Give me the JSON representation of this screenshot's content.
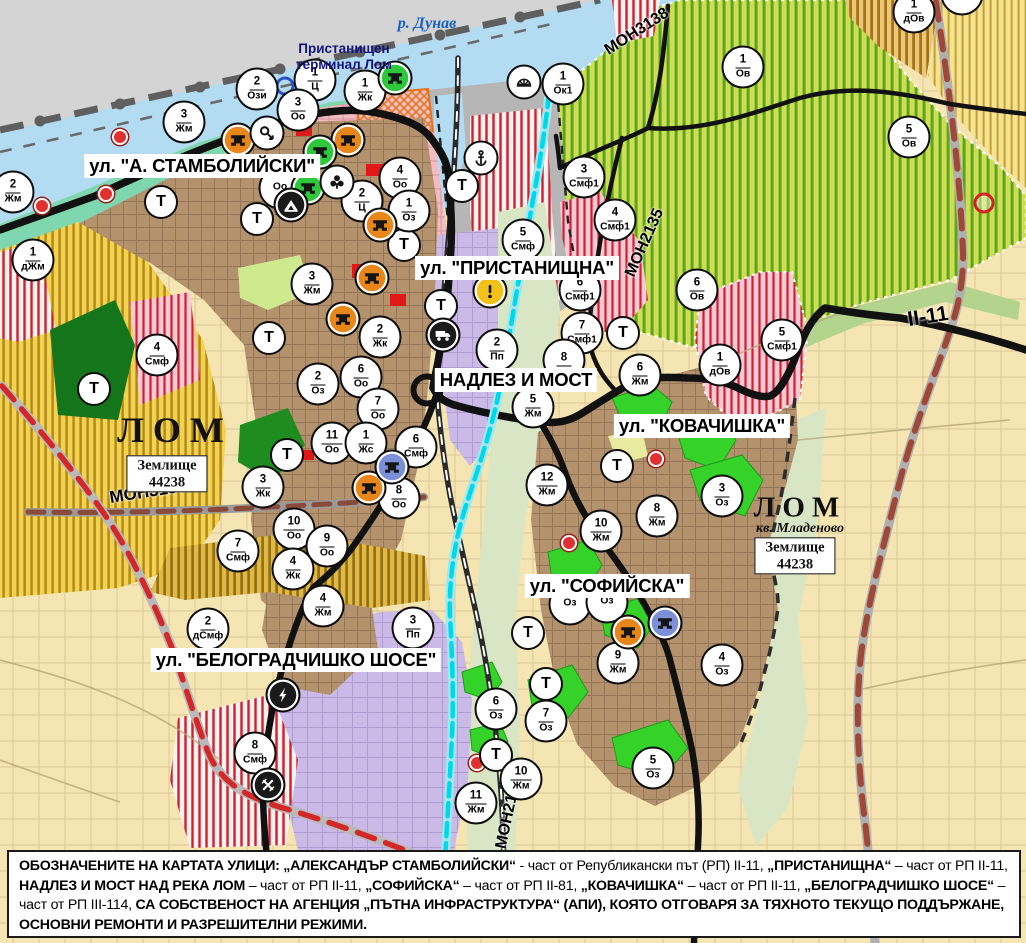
{
  "t_symbol": "Т",
  "labels": {
    "river": "р. Дунав",
    "port_line1": "Пристанищен",
    "port_line2": "терминал Лом",
    "lom": "ЛОМ",
    "kv": "кв. Младеново",
    "zem": "Землище",
    "zem_num": "44238"
  },
  "street_labels": [
    {
      "text": "ул. \"А. СТАМБОЛИЙСКИ\"",
      "x": 202,
      "y": 166
    },
    {
      "text": "ул. \"ПРИСТАНИЩНА\"",
      "x": 517,
      "y": 268
    },
    {
      "text": "НАДЛЕЗ И МОСТ",
      "x": 516,
      "y": 380
    },
    {
      "text": "ул. \"КОВАЧИШКА\"",
      "x": 702,
      "y": 426
    },
    {
      "text": "ул. \"СОФИЙСКА\"",
      "x": 607,
      "y": 586
    },
    {
      "text": "ул. \"БЕЛОГРАДЧИШКО ШОСЕ\"",
      "x": 296,
      "y": 660
    }
  ],
  "road_labels": [
    {
      "text": "МОН3139",
      "x": 148,
      "y": 492,
      "rot": -9,
      "size": 17
    },
    {
      "text": "МОН3138",
      "x": 637,
      "y": 32,
      "rot": -33,
      "size": 16
    },
    {
      "text": "МОН2135",
      "x": 645,
      "y": 243,
      "rot": -66,
      "size": 16
    },
    {
      "text": "МОН2136",
      "x": 509,
      "y": 813,
      "rot": -78,
      "size": 16
    },
    {
      "text": "II-11",
      "x": 928,
      "y": 317,
      "rot": -9,
      "size": 21
    }
  ],
  "zone_markers": [
    {
      "n": "2",
      "c": "Ози",
      "x": 257,
      "y": 89
    },
    {
      "n": "1",
      "c": "Ц",
      "x": 315,
      "y": 80
    },
    {
      "n": "1",
      "c": "Жк",
      "x": 365,
      "y": 91
    },
    {
      "n": "3",
      "c": "Оо",
      "x": 298,
      "y": 110
    },
    {
      "n": "3",
      "c": "Жм",
      "x": 184,
      "y": 122
    },
    {
      "n": "2",
      "c": "Жм",
      "x": 13,
      "y": 192
    },
    {
      "n": "1",
      "c": "дЖм",
      "x": 33,
      "y": 260
    },
    {
      "n": "4",
      "c": "Оо",
      "x": 400,
      "y": 178
    },
    {
      "n": "2",
      "c": "Ц",
      "x": 362,
      "y": 201
    },
    {
      "n": "1",
      "c": "Оз",
      "x": 409,
      "y": 211
    },
    {
      "n": "3",
      "c": "Жм",
      "x": 312,
      "y": 284
    },
    {
      "n": "",
      "c": "Оо",
      "x": 280,
      "y": 188
    },
    {
      "n": "4",
      "c": "Смф",
      "x": 157,
      "y": 355
    },
    {
      "n": "2",
      "c": "Жк",
      "x": 380,
      "y": 337
    },
    {
      "n": "2",
      "c": "Оз",
      "x": 318,
      "y": 384
    },
    {
      "n": "6",
      "c": "Оо",
      "x": 361,
      "y": 377
    },
    {
      "n": "7",
      "c": "Оо",
      "x": 378,
      "y": 409
    },
    {
      "n": "11",
      "c": "Оо",
      "x": 332,
      "y": 443
    },
    {
      "n": "1",
      "c": "Жс",
      "x": 366,
      "y": 443
    },
    {
      "n": "6",
      "c": "Смф",
      "x": 416,
      "y": 447
    },
    {
      "n": "8",
      "c": "Оо",
      "x": 399,
      "y": 498
    },
    {
      "n": "3",
      "c": "Жк",
      "x": 263,
      "y": 487
    },
    {
      "n": "10",
      "c": "Оо",
      "x": 294,
      "y": 529
    },
    {
      "n": "9",
      "c": "Оо",
      "x": 327,
      "y": 546
    },
    {
      "n": "7",
      "c": "Смф",
      "x": 238,
      "y": 551
    },
    {
      "n": "4",
      "c": "Жк",
      "x": 293,
      "y": 569
    },
    {
      "n": "2",
      "c": "Пп",
      "x": 497,
      "y": 350
    },
    {
      "n": "5",
      "c": "Смф",
      "x": 523,
      "y": 240
    },
    {
      "n": "1",
      "c": "Ок1",
      "x": 563,
      "y": 84
    },
    {
      "n": "3",
      "c": "Смф1",
      "x": 584,
      "y": 177
    },
    {
      "n": "4",
      "c": "Смф1",
      "x": 615,
      "y": 220
    },
    {
      "n": "6",
      "c": "Смф1",
      "x": 580,
      "y": 290
    },
    {
      "n": "7",
      "c": "Смф1",
      "x": 582,
      "y": 333
    },
    {
      "n": "8",
      "c": "",
      "x": 564,
      "y": 360
    },
    {
      "n": "5",
      "c": "Жм",
      "x": 533,
      "y": 407
    },
    {
      "n": "6",
      "c": "Жм",
      "x": 640,
      "y": 375
    },
    {
      "n": "6",
      "c": "Ов",
      "x": 697,
      "y": 290
    },
    {
      "n": "1",
      "c": "Ов",
      "x": 743,
      "y": 67
    },
    {
      "n": "5",
      "c": "Ов",
      "x": 909,
      "y": 137
    },
    {
      "n": "1",
      "c": "дОв",
      "x": 914,
      "y": 12
    },
    {
      "n": "",
      "c": "дОв",
      "x": 962,
      "y": -6
    },
    {
      "n": "5",
      "c": "Смф1",
      "x": 782,
      "y": 340
    },
    {
      "n": "1",
      "c": "дОв",
      "x": 720,
      "y": 365
    },
    {
      "n": "3",
      "c": "Оз",
      "x": 722,
      "y": 496
    },
    {
      "n": "8",
      "c": "Жм",
      "x": 657,
      "y": 516
    },
    {
      "n": "10",
      "c": "Жм",
      "x": 601,
      "y": 531
    },
    {
      "n": "12",
      "c": "Жм",
      "x": 547,
      "y": 485
    },
    {
      "n": "",
      "c": "Оз",
      "x": 570,
      "y": 604
    },
    {
      "n": "",
      "c": "Оз",
      "x": 607,
      "y": 602
    },
    {
      "n": "9",
      "c": "Жм",
      "x": 618,
      "y": 663
    },
    {
      "n": "4",
      "c": "Оз",
      "x": 722,
      "y": 665
    },
    {
      "n": "6",
      "c": "Оз",
      "x": 496,
      "y": 709
    },
    {
      "n": "7",
      "c": "Оз",
      "x": 546,
      "y": 721
    },
    {
      "n": "10",
      "c": "Жм",
      "x": 521,
      "y": 779
    },
    {
      "n": "11",
      "c": "Жм",
      "x": 476,
      "y": 803
    },
    {
      "n": "5",
      "c": "Оз",
      "x": 653,
      "y": 768
    },
    {
      "n": "2",
      "c": "дСмф",
      "x": 208,
      "y": 629
    },
    {
      "n": "4",
      "c": "Жм",
      "x": 323,
      "y": 606
    },
    {
      "n": "3",
      "c": "Пп",
      "x": 413,
      "y": 628
    },
    {
      "n": "8",
      "c": "Смф",
      "x": 255,
      "y": 753
    }
  ],
  "t_markers": [
    [
      161,
      202
    ],
    [
      257,
      219
    ],
    [
      404,
      245
    ],
    [
      462,
      186
    ],
    [
      441,
      306
    ],
    [
      623,
      333
    ],
    [
      617,
      466
    ],
    [
      94,
      389
    ],
    [
      269,
      338
    ],
    [
      287,
      455
    ],
    [
      528,
      633
    ],
    [
      546,
      684
    ],
    [
      496,
      755
    ]
  ],
  "icon_markers": [
    {
      "type": "monument",
      "variant": "orange",
      "x": 238,
      "y": 140
    },
    {
      "type": "monument",
      "variant": "orange",
      "x": 348,
      "y": 140
    },
    {
      "type": "monument",
      "variant": "orange",
      "x": 380,
      "y": 225
    },
    {
      "type": "monument",
      "variant": "orange",
      "x": 372,
      "y": 278
    },
    {
      "type": "monument",
      "variant": "orange",
      "x": 343,
      "y": 319
    },
    {
      "type": "monument",
      "variant": "orange",
      "x": 369,
      "y": 488
    },
    {
      "type": "monument",
      "variant": "orange",
      "x": 628,
      "y": 632
    },
    {
      "type": "monument",
      "variant": "green",
      "x": 320,
      "y": 152
    },
    {
      "type": "monument",
      "variant": "green",
      "x": 308,
      "y": 188
    },
    {
      "type": "monument",
      "variant": "green",
      "x": 395,
      "y": 78
    },
    {
      "type": "monument",
      "variant": "blue",
      "x": 392,
      "y": 467
    },
    {
      "type": "monument",
      "variant": "blue",
      "x": 665,
      "y": 623
    },
    {
      "type": "key",
      "variant": "white",
      "x": 267,
      "y": 133
    },
    {
      "type": "trefoil",
      "variant": "white",
      "x": 337,
      "y": 182
    },
    {
      "type": "cave",
      "variant": "black",
      "x": 291,
      "y": 205
    },
    {
      "type": "anchor",
      "variant": "white",
      "x": 481,
      "y": 158
    },
    {
      "type": "sunrise",
      "variant": "white",
      "x": 524,
      "y": 82
    },
    {
      "type": "truck",
      "variant": "black",
      "x": 443,
      "y": 335
    },
    {
      "type": "exclamation",
      "variant": "yellow",
      "x": 490,
      "y": 291
    },
    {
      "type": "lightning",
      "variant": "black",
      "x": 283,
      "y": 695
    },
    {
      "type": "rail-crossing",
      "variant": "black",
      "x": 268,
      "y": 785
    }
  ],
  "dots": [
    {
      "type": "red-dot",
      "x": 120,
      "y": 137
    },
    {
      "type": "red-dot",
      "x": 106,
      "y": 194
    },
    {
      "type": "red-dot",
      "x": 42,
      "y": 206
    },
    {
      "type": "red-dot",
      "x": 656,
      "y": 459
    },
    {
      "type": "red-dot",
      "x": 569,
      "y": 543
    },
    {
      "type": "red-dot",
      "x": 477,
      "y": 763
    },
    {
      "type": "blue-ring",
      "x": 285,
      "y": 86
    },
    {
      "type": "red-ring",
      "x": 984,
      "y": 203
    }
  ],
  "note_segments": [
    {
      "t": "ОБОЗНАЧЕНИТЕ НА КАРТАТА УЛИЦИ: „АЛЕКСАНДЪР СТАМБОЛИЙСКИ“",
      "b": true
    },
    {
      "t": " - част от Републикански път (РП) II-11, ",
      "b": false
    },
    {
      "t": "„ПРИСТАНИЩНА“",
      "b": true
    },
    {
      "t": " – част от РП II-11, ",
      "b": false
    },
    {
      "t": "НАДЛЕЗ И МОСТ НАД РЕКА ЛОМ",
      "b": true
    },
    {
      "t": " – част от РП II-11, ",
      "b": false
    },
    {
      "t": "„СОФИЙСКА“",
      "b": true
    },
    {
      "t": " – част от РП II-81, ",
      "b": false
    },
    {
      "t": "„КОВАЧИШКА“",
      "b": true
    },
    {
      "t": " – част от РП II-11, ",
      "b": false
    },
    {
      "t": "„БЕЛОГРАДЧИШКО ШОСЕ“",
      "b": true
    },
    {
      "t": " – част от РП III-114, ",
      "b": false
    },
    {
      "t": "СА СОБСТВЕНОСТ НА АГЕНЦИЯ „ПЪТНА ИНФРАСТРУКТУРА“ (АПИ), КОЯТО ОТГОВАРЯ ЗА ТЯХНОТО ТЕКУЩО ПОДДЪРЖАНЕ, ОСНОВНИ РЕМОНТИ И РАЗРЕШИТЕЛНИ РЕЖИМИ.",
      "b": true
    }
  ],
  "colors": {
    "water": "#b3dcf2",
    "shore": "#7fd7b0",
    "urban_brown": "#b3926d",
    "lavender": "#cbb9e8",
    "pink": "#f3bcc2",
    "port_gray": "#b6b6b6",
    "field": "#f4e5b2",
    "vineyard": "#c8d84e",
    "park_green": "#35d22a",
    "dark_green": "#15751a",
    "road_black": "#111111",
    "route_red": "#d42828",
    "channel_cyan": "#00d8ea",
    "icon_orange": "#e8861a",
    "icon_green": "#2ec83c",
    "icon_blue": "#7b90d8",
    "icon_white": "#ffffff",
    "icon_black": "#1a1a1a",
    "icon_yellow": "#f2c21a"
  }
}
